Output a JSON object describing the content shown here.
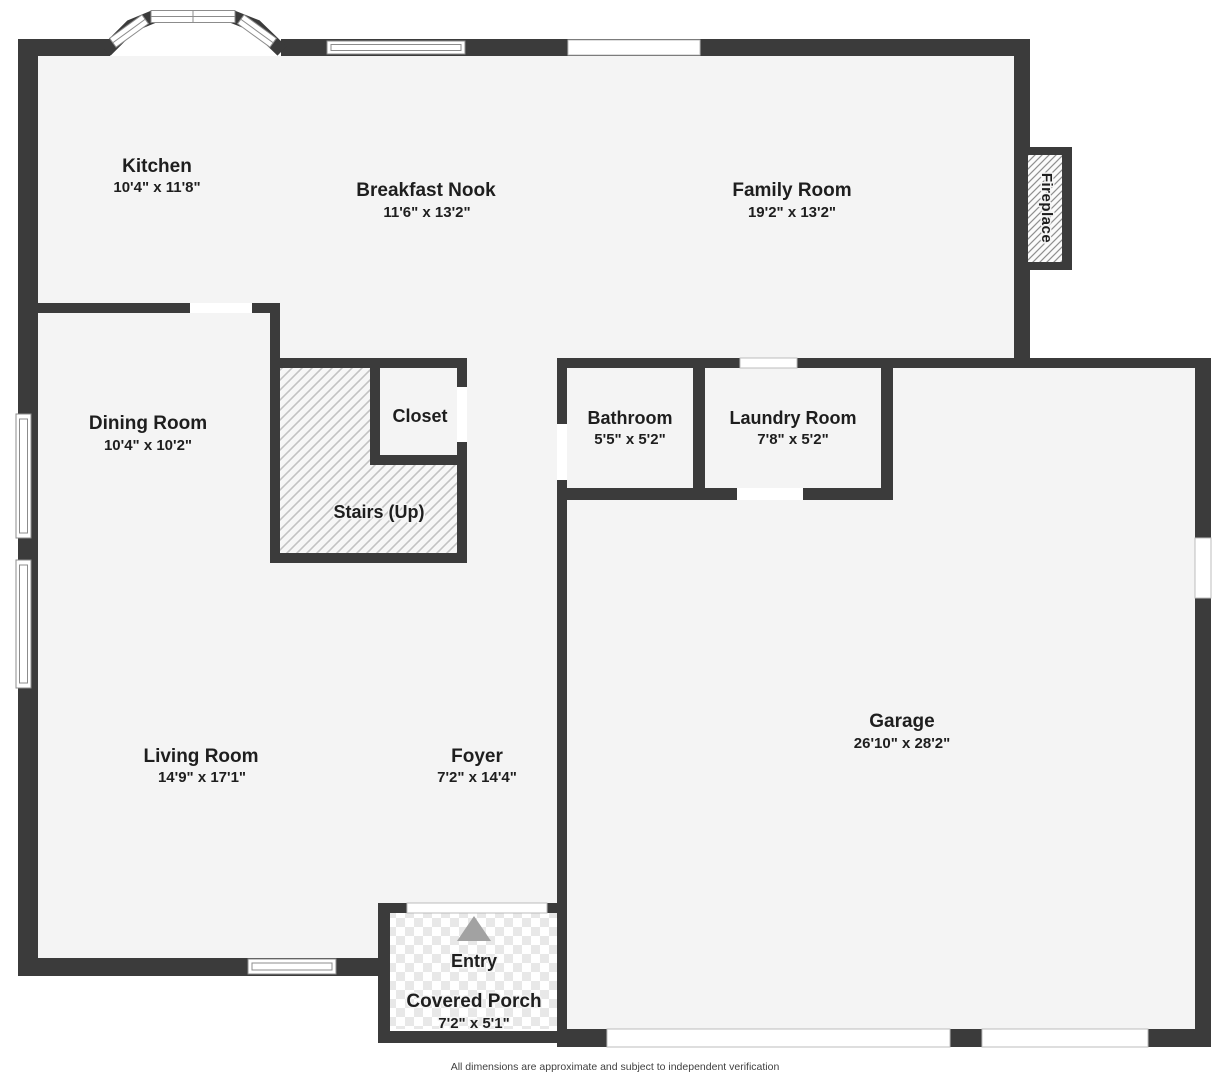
{
  "plan": {
    "title": "First floor plan",
    "rooms": {
      "kitchen": {
        "name": "Kitchen",
        "dims": "10'4\" x 11'8\""
      },
      "breakfast_nook": {
        "name": "Breakfast Nook",
        "dims": "11'6\" x 13'2\""
      },
      "family_room": {
        "name": "Family Room",
        "dims": "19'2\" x 13'2\""
      },
      "dining_room": {
        "name": "Dining Room",
        "dims": "10'4\" x 10'2\""
      },
      "closet": {
        "name": "Closet",
        "dims": ""
      },
      "stairs": {
        "name": "Stairs (Up)",
        "dims": ""
      },
      "bathroom": {
        "name": "Bathroom",
        "dims": "5'5\" x 5'2\""
      },
      "laundry_room": {
        "name": "Laundry Room",
        "dims": "7'8\" x 5'2\""
      },
      "living_room": {
        "name": "Living Room",
        "dims": "14'9\" x 17'1\""
      },
      "foyer": {
        "name": "Foyer",
        "dims": "7'2\" x 14'4\""
      },
      "garage": {
        "name": "Garage",
        "dims": "26'10\" x 28'2\""
      },
      "covered_porch": {
        "name": "Covered Porch",
        "dims": "7'2\" x 5'1\""
      }
    },
    "labels": {
      "entry": "Entry",
      "fireplace": "Fireplace"
    },
    "footer": "All dimensions are approximate and subject to independent verification",
    "colors": {
      "wall": "#3b3b3b",
      "floor": "#f4f4f4",
      "winline": "#8c8c8c",
      "text": "#1e1e1e",
      "arrow": "#a2a2a2",
      "hatch_line": "#c2c2c2",
      "fireplace_hatch_line": "#8f8f8f",
      "tile": "#e8e8e8"
    }
  }
}
